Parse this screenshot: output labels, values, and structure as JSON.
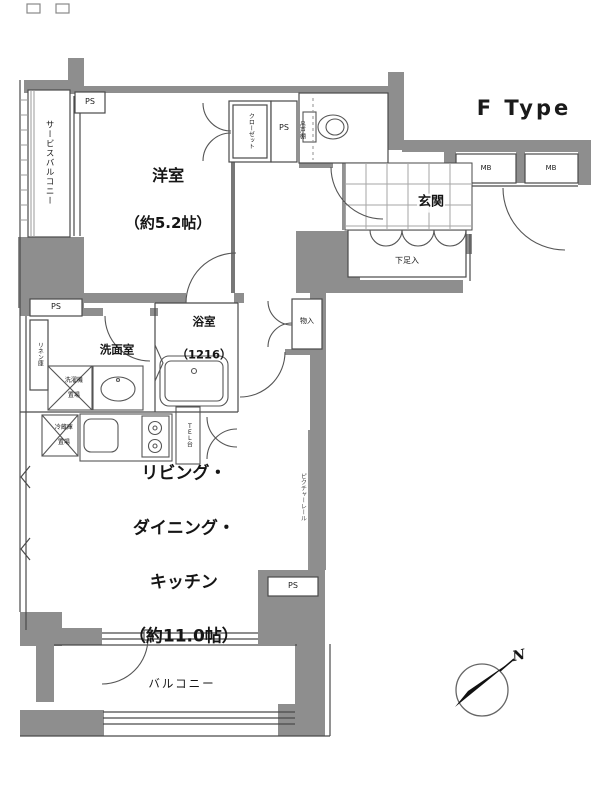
{
  "title": "F Type",
  "rooms": {
    "bedroom": {
      "name": "洋室",
      "size": "（約5.2帖）"
    },
    "ldk": {
      "line1": "リビング・",
      "line2": "ダイニング・",
      "line3": "キッチン",
      "line4": "（約11.0帖）"
    },
    "genkan": "玄関",
    "bath": {
      "name": "浴室",
      "size": "（1216）"
    },
    "washroom": "洗面室",
    "toilet_shelf": "吊戸棚",
    "balcony": "バルコニー",
    "service_balcony": "サービスバルコニー"
  },
  "storage": {
    "closet": "クローゼット",
    "hall_closet": "物入",
    "shoe_cabinet": "下足入",
    "linen": "リネン庫"
  },
  "kitchen": {
    "washer_line1": "洗濯機",
    "washer_line2": "置場",
    "fridge_line1": "冷蔵庫",
    "fridge_line2": "置場",
    "tel_stand": "ＴＥＬ台"
  },
  "labels": {
    "ps": "PS",
    "mb": "MB",
    "picture_rail": "ピクチャーレール",
    "north": "N"
  },
  "colors": {
    "wall": "#8e8e8e",
    "line": "#4a4a4a",
    "text": "#111111"
  }
}
